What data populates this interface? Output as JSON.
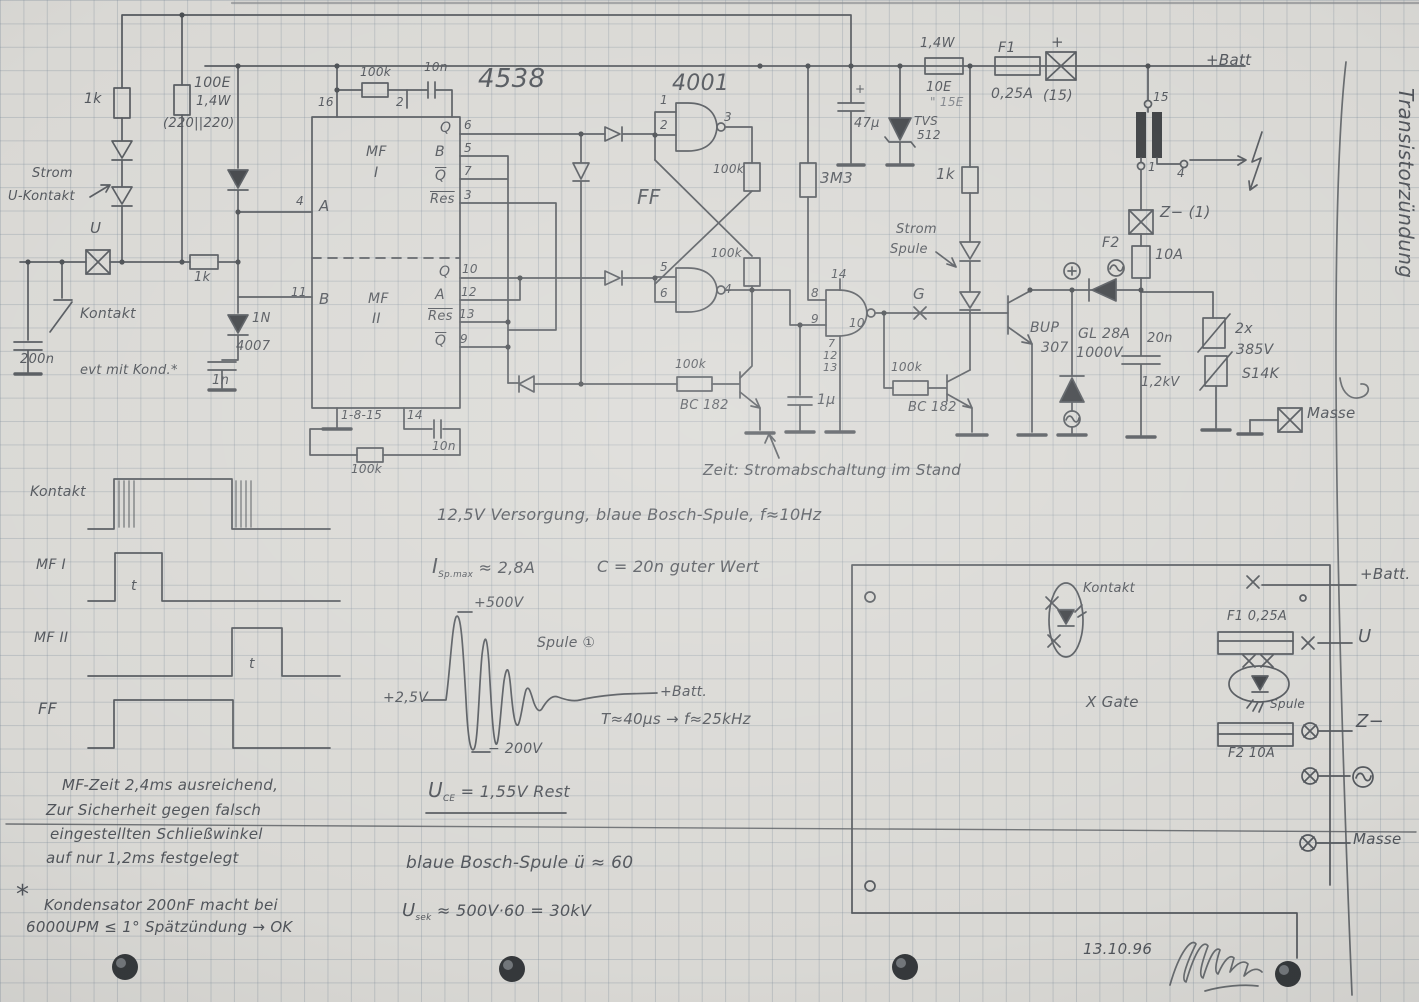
{
  "colors": {
    "paper": "#d9d8d4",
    "grid_line": "#aeb7bf",
    "pencil": "#53575c",
    "pencil_dark": "#3e4145"
  },
  "title_block": {
    "heading": "Transistorzündung",
    "date": "13.10.96"
  },
  "input": {
    "r1k_top": "1k",
    "r100e": "100E",
    "r100e_w": "1,4W",
    "r100e_note": "(220||220)",
    "strom": "Strom",
    "u_kontakt": "U-Kontakt",
    "u_term": "U",
    "r1k_mid": "1k",
    "kontakt": "Kontakt",
    "c200n": "200n",
    "kond_note": "evt mit Kond.*",
    "c1n": "1n",
    "d1": "1N",
    "d2": "4007"
  },
  "ic4538": {
    "name": "4538",
    "pin16": "16",
    "r100k_top": "100k",
    "c10n_top": "10n",
    "pin2": "2",
    "pin4": "4",
    "in_a": "A",
    "mf1a": "MF",
    "mf1b": "I",
    "q1": "Q",
    "b1": "B",
    "qb1": "Q",
    "res1": "Res",
    "p6": "6",
    "p5": "5",
    "p7": "7",
    "p3": "3",
    "pin11": "11",
    "in_b": "B",
    "mf2a": "MF",
    "mf2b": "II",
    "q2": "Q",
    "a2": "A",
    "res2": "Res",
    "qb2": "Q",
    "p10": "10",
    "p12": "12",
    "p13": "13",
    "p9": "9",
    "gnd_pins": "1-8-15",
    "pin14": "14",
    "c10n_bot": "10n",
    "r100k_bot": "100k"
  },
  "ic4001": {
    "name": "4001",
    "p1": "1",
    "p2": "2",
    "p3": "3",
    "ff": "FF",
    "r100k_a": "100k",
    "r100k_b": "100k",
    "p5": "5",
    "p6": "6",
    "p4": "4",
    "p8": "8",
    "p9": "9",
    "p10": "10",
    "p14": "14",
    "p7": "7",
    "p12": "12",
    "p13": "13"
  },
  "supply": {
    "c47u": "47µ",
    "plus": "+",
    "tvs1": "TVS",
    "tvs2": "512",
    "w": "1,4W",
    "r10e": "10E",
    "r10e_alt": "\" 15E",
    "f1": "F1",
    "f1_a": "0,25A",
    "t15_plus": "+",
    "t15": "(15)",
    "r1k": "1k",
    "r3m3": "3M3",
    "batt": "+Batt"
  },
  "driver": {
    "strom": "Strom",
    "spule": "Spule",
    "g": "G",
    "r100k_l": "100k",
    "bc_l": "BC 182",
    "c1u": "1µ",
    "r100k_r": "100k",
    "bc_r": "BC 182",
    "bup1": "BUP",
    "bup2": "307",
    "gl1": "GL 28A",
    "gl2": "1000V"
  },
  "out": {
    "t15": "15",
    "t1": "1",
    "t4": "4",
    "z": "Z− (1)",
    "f2": "F2",
    "f2_a": "10A",
    "c20n": "20n",
    "c20n_v": "1,2kV",
    "var1": "2x",
    "var2": "385V",
    "var3": "S14K",
    "masse": "Masse"
  },
  "annotation": {
    "zeit": "Zeit: Stromabschaltung im Stand"
  },
  "timing": {
    "rows": [
      {
        "label": "Kontakt"
      },
      {
        "label": "MF I",
        "t": "t"
      },
      {
        "label": "MF II",
        "t": "t"
      },
      {
        "label": "FF"
      }
    ]
  },
  "notes": {
    "supply": "12,5V Versorgung, blaue Bosch-Spule, f≈10Hz",
    "i_sym": "I",
    "i_sub": "Sp.max",
    "i_val": "≈ 2,8A",
    "c_val": "C = 20n guter Wert",
    "w_peak": "+500V",
    "w_coil": "Spule ①",
    "w_base": "+2,5V",
    "w_neg": "− 200V",
    "w_batt": "+Batt.",
    "w_period": "T≈40µs → f≈25kHz",
    "uce_sym": "U",
    "uce_sub": "CE",
    "uce_val": "= 1,55V Rest",
    "ratio": "blaue Bosch-Spule  ü ≈ 60",
    "usek_sym": "U",
    "usek_sub": "sek",
    "usek_val": "≈ 500V·60 = 30kV",
    "mf1": "MF-Zeit 2,4ms ausreichend,",
    "mf2": "Zur Sicherheit gegen falsch",
    "mf3": "eingestellten Schließwinkel",
    "mf4": "auf nur 1,2ms festgelegt",
    "star": "*",
    "kond1": "Kondensator 200nF macht bei",
    "kond2": "6000UPM ≤ 1° Spätzündung → OK"
  },
  "board": {
    "kontakt": "Kontakt",
    "gate": "X Gate",
    "batt": "+Batt.",
    "u": "U",
    "f1": "F1 0,25A",
    "spule": "Spule",
    "f2": "F2 10A",
    "z": "Z−",
    "masse": "Masse"
  }
}
